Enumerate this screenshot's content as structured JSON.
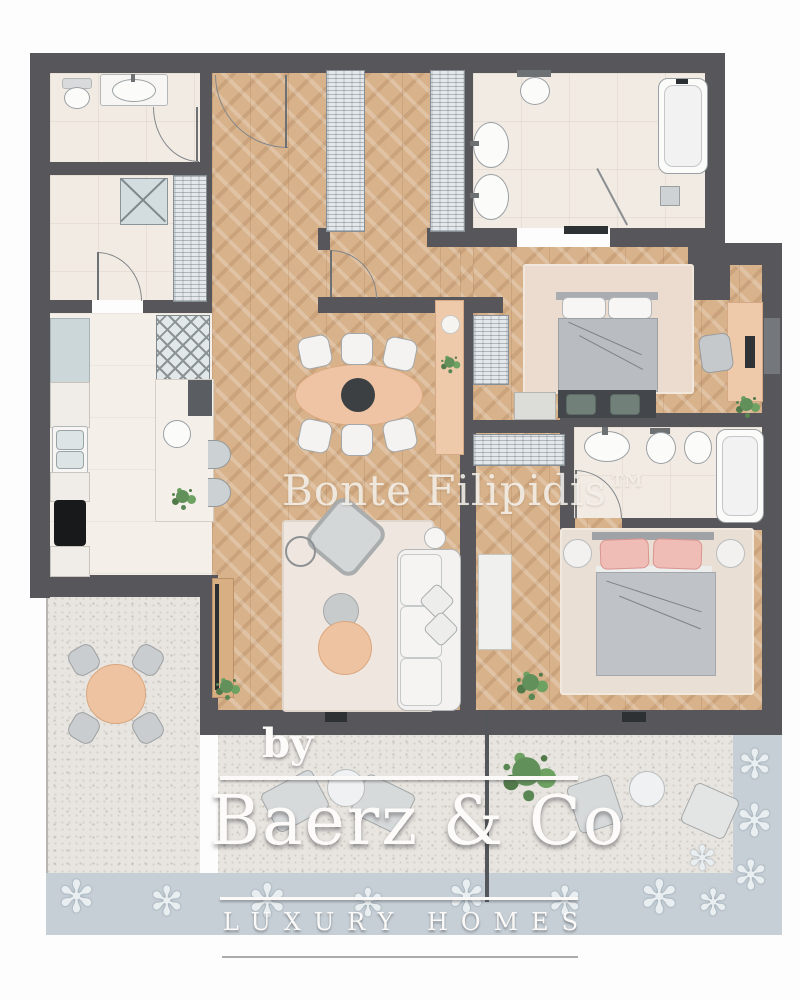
{
  "watermark": "Bonte Filipidis™",
  "logo": {
    "prefix": "by",
    "brand": "Baerz & Co",
    "tagline": "LUXURY HOMES"
  },
  "garden": {
    "flower_glyph": "✻"
  },
  "palette": {
    "wall": "#57575b",
    "wood_floor": "#d8b28a",
    "tile_floor": "#f2ebe3",
    "stone_terrace": "#e8e5e0",
    "garden_band": "#c6cfd6",
    "accent_peach": "#eec4a4",
    "accent_pink": "#f0bcb6",
    "furniture_gray": "#c6c9ca",
    "logo_text": "#fcfbf9"
  }
}
